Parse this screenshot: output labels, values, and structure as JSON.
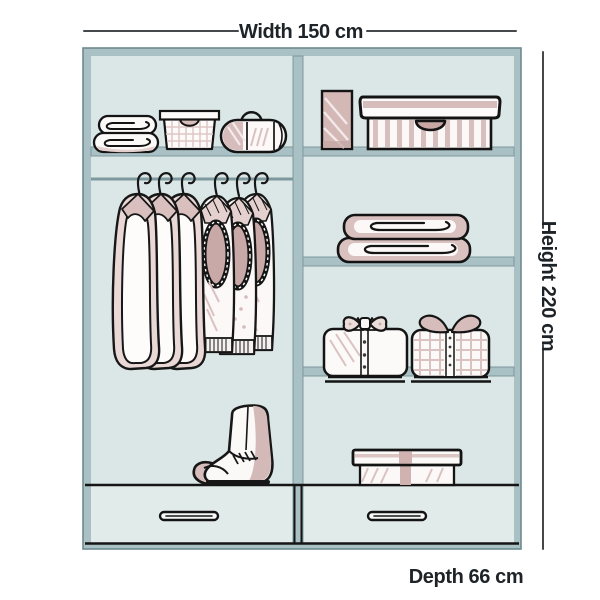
{
  "diagram": {
    "type": "wardrobe-interior-dimensions",
    "labels": {
      "width": "Width 150 cm",
      "height": "Height 220 cm",
      "depth": "Depth 66 cm"
    }
  },
  "wardrobe": {
    "sections": [
      {
        "name": "left",
        "top_shelf_items": [
          "folded-towels",
          "wire-basket",
          "duffel-bag"
        ],
        "rail_items": [
          "hanging-shirt",
          "hanging-shirt",
          "hanging-shirt",
          "hanging-tank-top",
          "hanging-tank-top",
          "hanging-tank-top"
        ],
        "floor_items": [
          "boots"
        ],
        "drawers": 1
      },
      {
        "name": "right",
        "shelves": [
          [
            "small-box",
            "striped-storage-box"
          ],
          [
            "folded-blankets"
          ],
          [
            "folded-shirt-bowtie",
            "folded-shirt-collar"
          ],
          [
            "gift-box"
          ]
        ],
        "drawers": 1
      }
    ]
  },
  "colors": {
    "background": "#ffffff",
    "frame": "#a9c0c4",
    "frameEdge": "#7d989e",
    "panel": "#dbe7e6",
    "drawerPanel": "#e1ebea",
    "outline": "#171717",
    "mauve": "#cfb3b1",
    "mauveLight": "#e6d5d3",
    "dimensionLine": "#45484a",
    "textColor": "#1d2327"
  }
}
